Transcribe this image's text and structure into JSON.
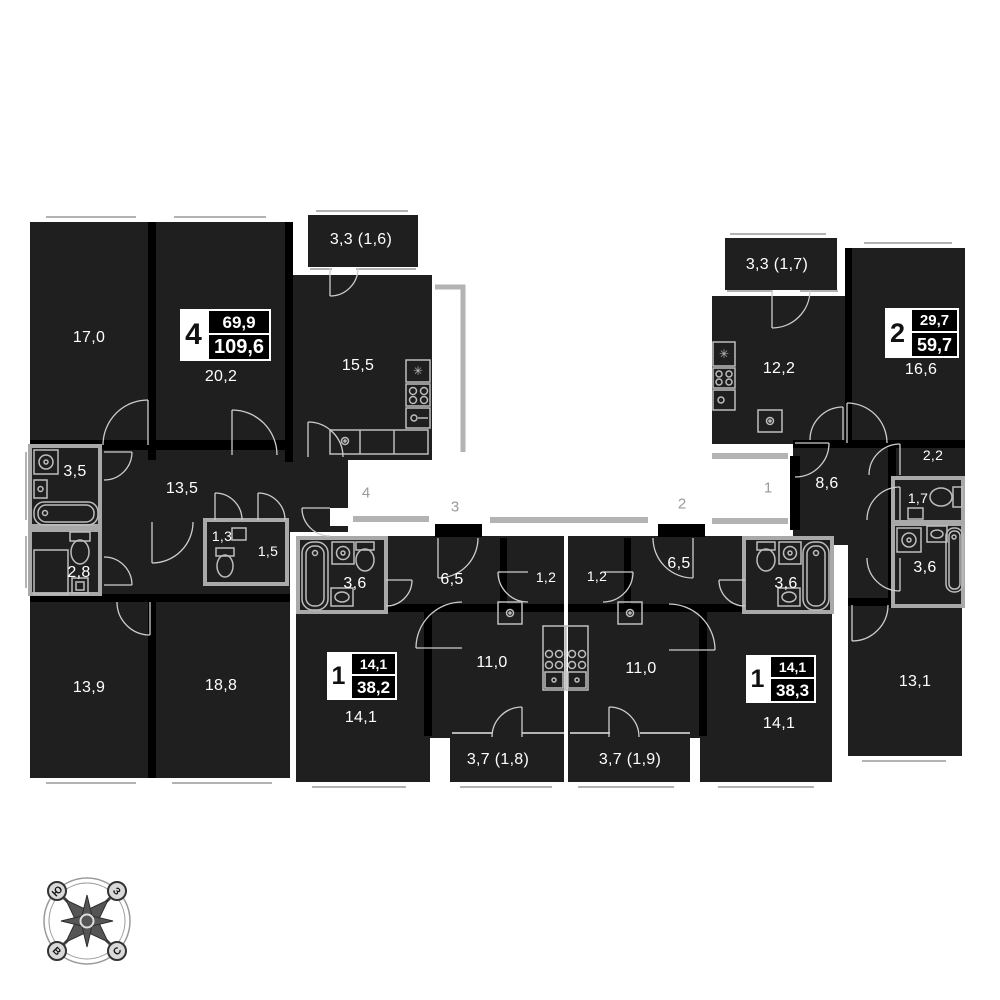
{
  "apartments": [
    {
      "badge": "4",
      "living_area": "69,9",
      "total_area": "109,6",
      "rooms": {
        "bedroom1": "17,0",
        "bedroom2": "20,2",
        "kitchen": "15,5",
        "balcony": "3,3 (1,6)",
        "bathroom": "3,5",
        "hall": "13,5",
        "wc": "1,3",
        "storage": "1,5",
        "wc2": "2,8",
        "bedroom3": "13,9",
        "bedroom4": "18,8"
      }
    },
    {
      "badge": "1",
      "living_area": "14,1",
      "total_area": "38,2",
      "rooms": {
        "bathroom": "3,6",
        "hall": "6,5",
        "closet": "1,2",
        "kitchen": "11,0",
        "room": "14,1",
        "balcony": "3,7 (1,8)"
      }
    },
    {
      "badge": "1",
      "living_area": "14,1",
      "total_area": "38,3",
      "rooms": {
        "closet": "1,2",
        "hall": "6,5",
        "bathroom": "3,6",
        "kitchen": "11,0",
        "room": "14,1",
        "balcony": "3,7 (1,9)"
      }
    },
    {
      "badge": "2",
      "living_area": "29,7",
      "total_area": "59,7",
      "rooms": {
        "balcony": "3,3 (1,7)",
        "kitchen": "12,2",
        "room1": "16,6",
        "hall": "8,6",
        "closet": "2,2",
        "wc": "1,7",
        "bathroom": "3,6",
        "room2": "13,1"
      }
    }
  ],
  "corridor": {
    "units": [
      "4",
      "3",
      "2",
      "1"
    ]
  },
  "compass": {
    "north": "С",
    "south": "Ю",
    "west": "З",
    "east": "В"
  },
  "colors": {
    "room_fill": "#1f1f1f",
    "wall": "#000000",
    "fixture": "#bdbdbd",
    "muted_gray": "#9a9a9a",
    "label": "#ffffff"
  }
}
